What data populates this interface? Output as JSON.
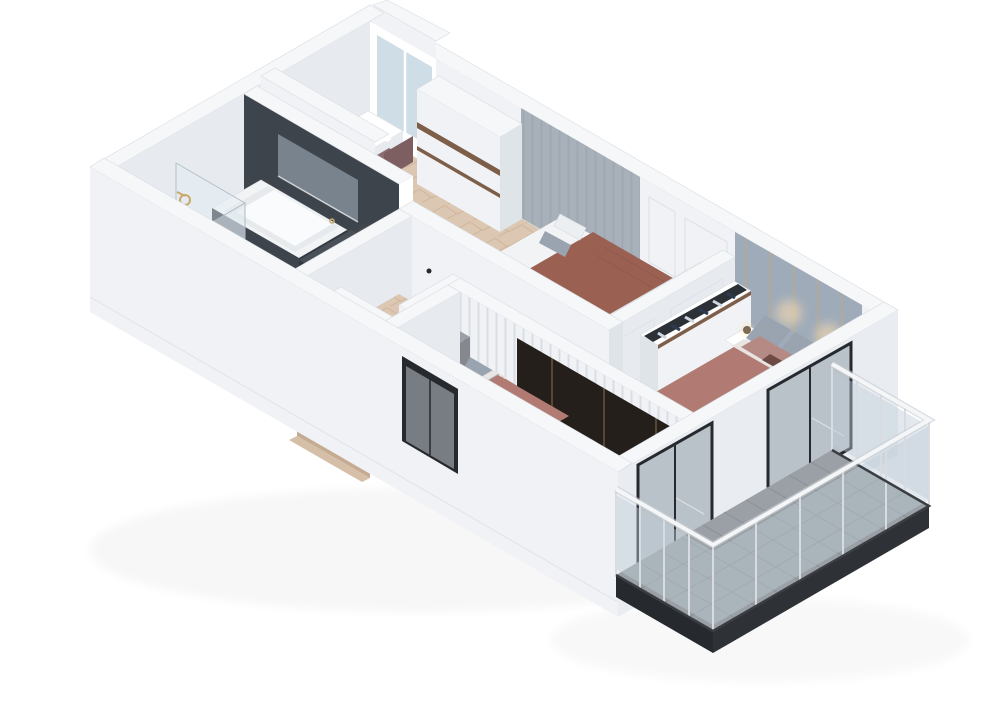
{
  "title": "3D isometric floor plan — upper floor apartment",
  "background": "#ffffff",
  "colors": {
    "background": "#ffffff",
    "wallTop": "#f6f7f9",
    "wallFaceSE": "#e7ebf0",
    "wallFaceSW": "#f0f2f5",
    "wallOuter": "#e9edf2",
    "wallShade": "#dfe4e9",
    "lineSoft": "#dfe3e8",
    "marbleDark": "#3d444c",
    "marbleDarker": "#333941",
    "marbleSlot": "#78838e",
    "floorMarble": "#eaecee",
    "marbleLine": "#d8dce0",
    "floorWood": "#dcc7b2",
    "woodLine": "#c9ae94",
    "stripeWall": "#a8b0ba",
    "stripeLine": "#99a2ac",
    "headboard": "#9fabb9",
    "gold": "#c9a86a",
    "glowWarm": "#ffdfae",
    "glassBlue": "#cfdde6",
    "tubWhite": "#f1f3f5",
    "vanityTop": "#4a5057",
    "vanityFront": "#33383e",
    "vanitySide": "#3a4046",
    "bedFrame": "#9aa0a7",
    "bedFrameShade": "#85898f",
    "bedFrameSide": "#8d9298",
    "mattress": "#f2f3f5",
    "blanketBrown": "#9a6153",
    "blanketBrownDark": "#8b584c",
    "bedMauve": "#b17b73",
    "bedMauveDark": "#a06c65",
    "sheet": "#e8e4e2",
    "pillowGray": "#9aa4b0",
    "pillowLight": "#eceff2",
    "pillowMauve": "#b58a85",
    "cushion": "#6e4a45",
    "chairMaroon": "#7c4a42",
    "chairMaroonDark": "#6d403a",
    "chairMauve": "#8d6e70",
    "chairMauveDark": "#7d5f62",
    "woodTrim": "#7d5f49",
    "woodShelf": "#8a6a4d",
    "woodShelf2": "#9b7a59",
    "tvDark": "#241f1b",
    "closetCavity": "#2c3138",
    "clothesNavy": "#2e3a52",
    "clothesLight": "#cfd6de",
    "plate": "#dce4ea",
    "plantGreen": "#4c684a",
    "plantGreen2": "#5d7a57",
    "potGray": "#8a8f94",
    "tileGray": "#9aa0a5",
    "tileLine": "#878d92",
    "slabDark": "#2e3236",
    "slabDarker": "#26292d",
    "railGlass": "rgba(190,205,215,0.45)",
    "railPost": "#d8dce0",
    "handrail": "#f4f6f8",
    "frameDark": "#26292d",
    "doorGlass": "#b9c2c8",
    "itemBlue": "#5b7fae",
    "legWood": "#8a6f52"
  },
  "scene": {
    "view": "isometric-cutaway",
    "rooms": [
      {
        "name": "bathroom",
        "floor": "white-marble",
        "features": [
          "dark-marble-accent-wall",
          "wall-niche-window",
          "bathtub-with-dark-marble-apron",
          "walk-in-glass-shower",
          "gold-shower-fixtures",
          "dark-vanity-with-sink",
          "warm-mirror-light"
        ]
      },
      {
        "name": "bedroom-top",
        "floor": "herringbone-parquet",
        "features": [
          "window",
          "desk",
          "chair",
          "tall-wardrobe-with-wood-strips",
          "single-bed-brown-blanket",
          "slat-accent-wall",
          "open-shelf-unit-with-plates",
          "open-wardrobe-with-clothes"
        ]
      },
      {
        "name": "bedroom-master",
        "floor": "herringbone-parquet",
        "features": [
          "upholstered-headboard-wall-with-gold-trim",
          "wall-sconce-glows",
          "double-bed-mauve-bedding",
          "two-nightstands",
          "table-lamps",
          "open-wardrobe-with-clothes",
          "vanity-desk",
          "leather-chair"
        ]
      },
      {
        "name": "bedroom-bottom",
        "floor": "herringbone-parquet",
        "features": [
          "single-bed-mauve-bedding",
          "gray-headboard",
          "potted-plant",
          "desk",
          "leather-chair",
          "media-wall-dark-panel",
          "wood-shelf",
          "open-wardrobe-with-clothes",
          "sliding-glass-door"
        ]
      },
      {
        "name": "hallway",
        "floor": "herringbone-parquet",
        "features": [
          "staircase-wood-treads",
          "stair-half-walls",
          "paneled-doors-with-black-handles"
        ]
      },
      {
        "name": "balcony",
        "floor": "gray-concrete-tiles",
        "features": [
          "glass-balustrade",
          "metal-posts",
          "white-handrail",
          "dark-slab-edge",
          "two-sliding-glass-doors"
        ]
      }
    ]
  }
}
